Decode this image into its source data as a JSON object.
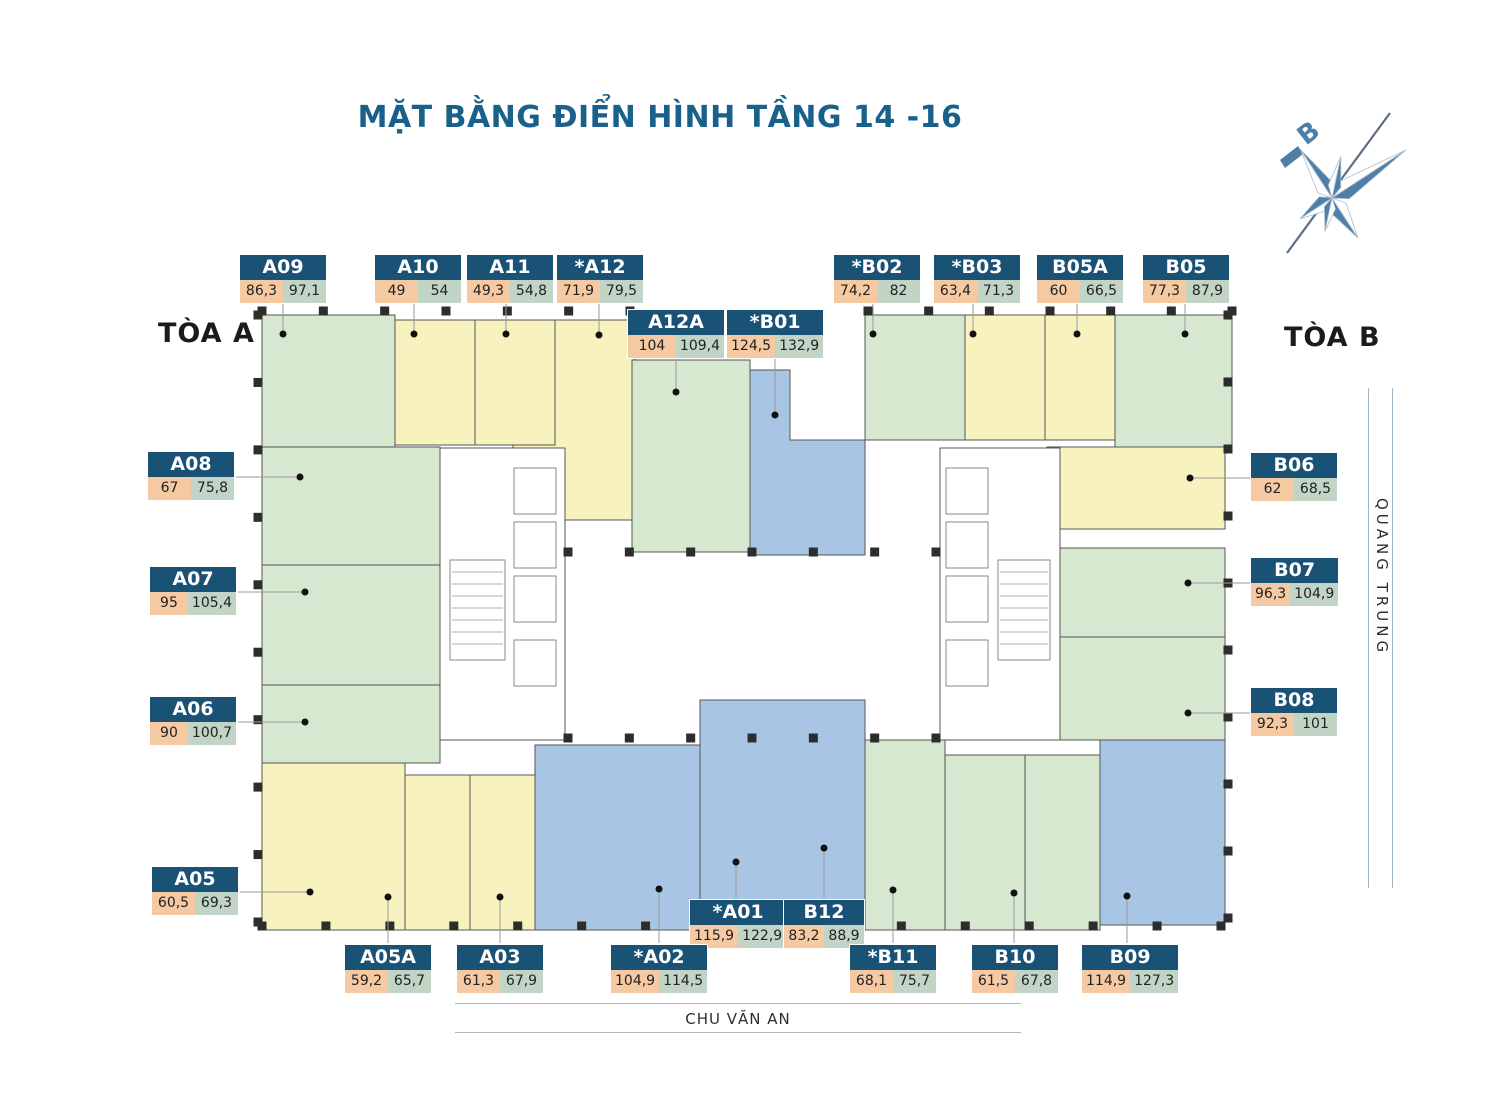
{
  "title": "MẶT BẰNG ĐIỂN HÌNH TẦNG 14 -16",
  "tower_a_label": "TÒA A",
  "tower_b_label": "TÒA B",
  "street_right": "QUANG TRUNG",
  "street_bottom": "CHU VĂN AN",
  "compass_north_label": "B",
  "colors": {
    "title_text": "#19608a",
    "label_header": "#1a5276",
    "area_net": "#f5c9a1",
    "area_gross": "#c2d4c5",
    "zone_green": "#d6e8d0",
    "zone_yellow": "#f8f2be",
    "zone_blue": "#a8c6e4",
    "wall_line": "#555555"
  },
  "units": [
    {
      "id": "A09",
      "area1": "86,3",
      "area2": "97,1"
    },
    {
      "id": "A10",
      "area1": "49",
      "area2": "54"
    },
    {
      "id": "A11",
      "area1": "49,3",
      "area2": "54,8"
    },
    {
      "id": "*A12",
      "area1": "71,9",
      "area2": "79,5"
    },
    {
      "id": "A12A",
      "area1": "104",
      "area2": "109,4"
    },
    {
      "id": "*B01",
      "area1": "124,5",
      "area2": "132,9"
    },
    {
      "id": "*B02",
      "area1": "74,2",
      "area2": "82"
    },
    {
      "id": "*B03",
      "area1": "63,4",
      "area2": "71,3"
    },
    {
      "id": "B05A",
      "area1": "60",
      "area2": "66,5"
    },
    {
      "id": "B05",
      "area1": "77,3",
      "area2": "87,9"
    },
    {
      "id": "A08",
      "area1": "67",
      "area2": "75,8"
    },
    {
      "id": "A07",
      "area1": "95",
      "area2": "105,4"
    },
    {
      "id": "A06",
      "area1": "90",
      "area2": "100,7"
    },
    {
      "id": "A05",
      "area1": "60,5",
      "area2": "69,3"
    },
    {
      "id": "B06",
      "area1": "62",
      "area2": "68,5"
    },
    {
      "id": "B07",
      "area1": "96,3",
      "area2": "104,9"
    },
    {
      "id": "B08",
      "area1": "92,3",
      "area2": "101"
    },
    {
      "id": "*A01",
      "area1": "115,9",
      "area2": "122,9"
    },
    {
      "id": "B12",
      "area1": "83,2",
      "area2": "88,9"
    },
    {
      "id": "A05A",
      "area1": "59,2",
      "area2": "65,7"
    },
    {
      "id": "A03",
      "area1": "61,3",
      "area2": "67,9"
    },
    {
      "id": "*A02",
      "area1": "104,9",
      "area2": "114,5"
    },
    {
      "id": "*B11",
      "area1": "68,1",
      "area2": "75,7"
    },
    {
      "id": "B10",
      "area1": "61,5",
      "area2": "67,8"
    },
    {
      "id": "B09",
      "area1": "114,9",
      "area2": "127,3"
    }
  ]
}
